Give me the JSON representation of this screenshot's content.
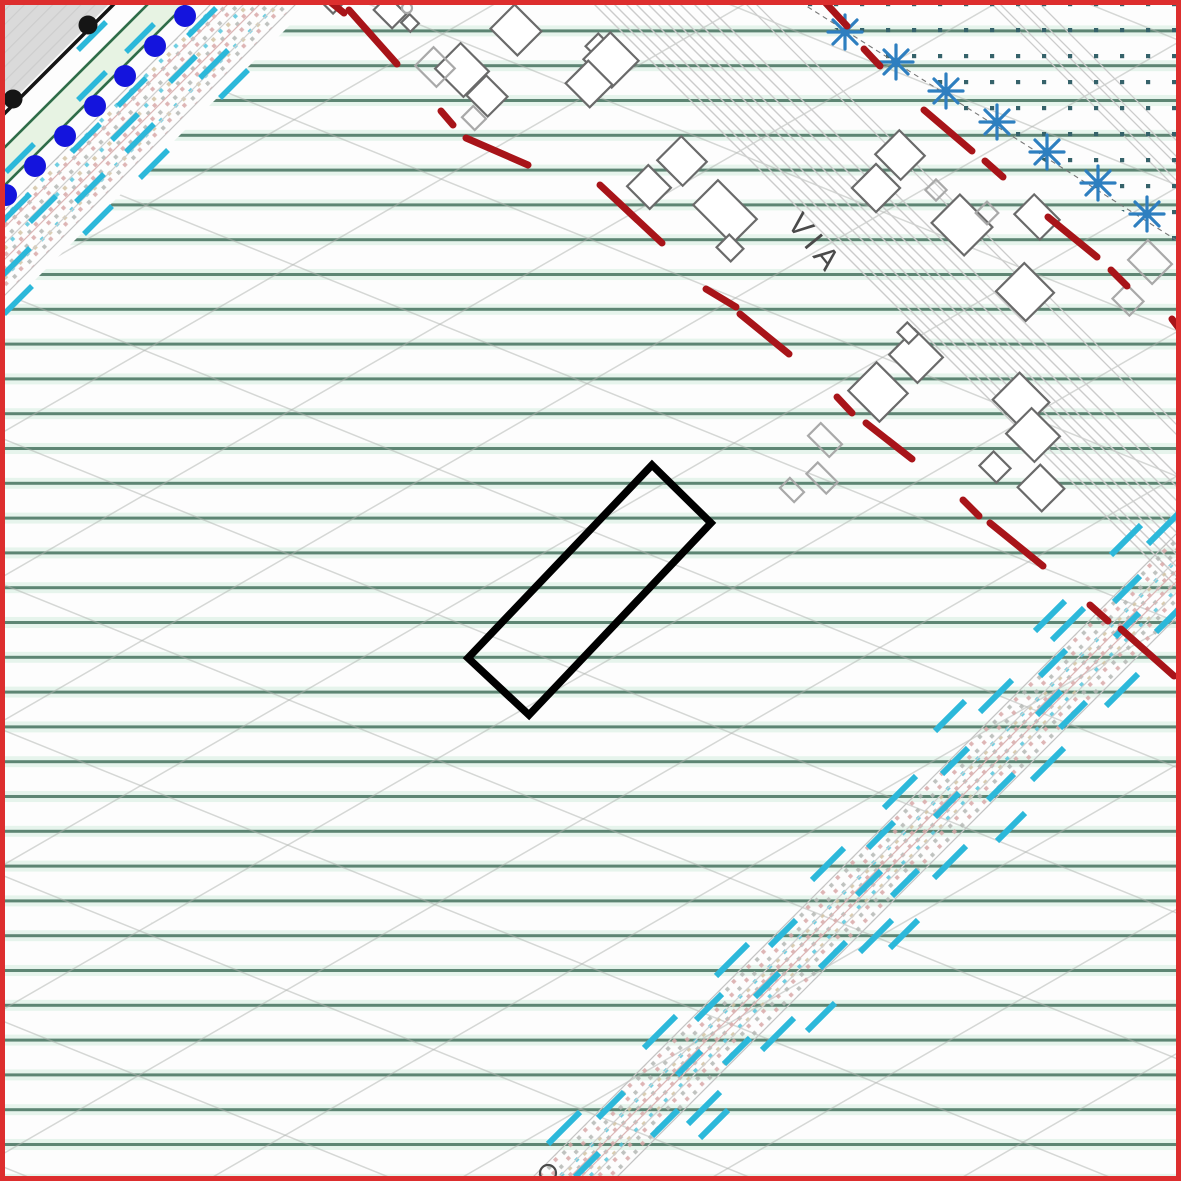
{
  "map": {
    "via_label": {
      "text": "VIA",
      "x": 786,
      "y": 224,
      "rotate": 51,
      "size": 31,
      "letter_spacing": 6
    },
    "palette": {
      "frame_red": "#dd2e2e",
      "hatch_green": "#5d8573",
      "hatch_green_halo": "#e6f4ec",
      "diag_gray": "#adb2ad",
      "road_gray": "#cbcbcb",
      "building_dark": "#6a6a6a",
      "building_light": "#a9a9a9",
      "red_dash": "#a81419",
      "cyan_dash": "#2cb8da",
      "corridor_edge": "#c4c4c4",
      "corridor_line_pink": "#dcb6b6",
      "corridor_line_gray": "#cfcfcf",
      "corridor_dot_pink": "#d8a8a8",
      "corridor_dot_gray": "#b4b8b4",
      "corridor_dot_cyan": "#56c6dc",
      "corridor_dot_tan": "#d2c3a4",
      "teal_dot": "#35626a",
      "asterisk_blue": "#2e7fc0",
      "asterisk_wire": "#777777",
      "blue_dot": "#1414dd",
      "black": "#151515",
      "green_band_line": "#2f6d49",
      "green_band_fill": "#e7f3e3",
      "gray_area": "#dadada",
      "via_text": "#4a4a4a",
      "parcel": "#000000",
      "background": "#fdfdfd"
    },
    "hatches": {
      "green": {
        "spacing": 34.8,
        "phase": 13.5,
        "line_w": 3.0,
        "halo_w": 4.0
      },
      "diag_up": {
        "angle": -30,
        "spacing": 125,
        "line_w": 1.5
      },
      "diag_down": {
        "angle": 22,
        "spacing": 135,
        "line_w": 1.5
      },
      "rural_clip": [
        [
          315,
          0
        ],
        [
          1181,
          0
        ],
        [
          1181,
          1181
        ],
        [
          0,
          1181
        ],
        [
          0,
          315
        ]
      ]
    },
    "gray_corner": {
      "points": [
        [
          0,
          0
        ],
        [
          113,
          0
        ],
        [
          0,
          113
        ]
      ]
    },
    "black_line": {
      "x1": 122,
      "y1": -4,
      "x2": -4,
      "y2": 122,
      "width": 3.5,
      "dot_r": 9.5,
      "dots": [
        [
          88,
          25
        ],
        [
          13,
          99
        ]
      ]
    },
    "green_band": {
      "offsets": [
        152,
        190
      ],
      "line_w": 2.6,
      "fill_quad": [
        [
          152,
          0
        ],
        [
          190,
          0
        ],
        [
          0,
          190
        ],
        [
          0,
          152
        ]
      ]
    },
    "blue_dots": {
      "r": 11,
      "centers": [
        [
          185,
          16
        ],
        [
          155,
          46
        ],
        [
          125,
          76
        ],
        [
          95,
          106
        ],
        [
          65,
          136
        ],
        [
          35,
          166
        ],
        [
          6,
          195
        ]
      ]
    },
    "teal_region": {
      "polygon": [
        [
          790,
          0
        ],
        [
          1181,
          0
        ],
        [
          1181,
          248
        ]
      ],
      "grid": 26,
      "dot": 4.2
    },
    "asterisk_line": {
      "x1": 800,
      "y1": 2,
      "x2": 1181,
      "y2": 243
    },
    "asterisks": {
      "size": 17,
      "arm_w": 3.2,
      "centers": [
        [
          845,
          32
        ],
        [
          896,
          62
        ],
        [
          946,
          91
        ],
        [
          997,
          122
        ],
        [
          1047,
          152
        ],
        [
          1098,
          183
        ],
        [
          1147,
          214
        ]
      ]
    },
    "roads": {
      "main": {
        "offsets": [
          590,
          600,
          610,
          622,
          632,
          644,
          654,
          664,
          676,
          690,
          702
        ],
        "width": 1.4
      },
      "west": {
        "offsets": [
          742,
          752
        ],
        "width": 1.3
      },
      "far": {
        "offsets": [
          988,
          996,
          1012,
          1020,
          1036
        ],
        "width": 1.3
      }
    },
    "corridors": [
      {
        "name": "tl",
        "band": [
          215,
          300
        ],
        "inner": [
          [
            232,
            "pink"
          ],
          [
            248,
            "gray"
          ],
          [
            264,
            "pink"
          ],
          [
            282,
            "gray"
          ]
        ],
        "dash_w": 5.5,
        "strips": [
          {
            "o": 128,
            "x0": 78,
            "n": 2,
            "step": 48,
            "len": 28
          },
          {
            "o": 178,
            "x0": 6,
            "n": 3,
            "step": 60,
            "len": 28
          },
          {
            "o": 224,
            "x0": 2,
            "n": 4,
            "step": 58,
            "len": 28
          },
          {
            "o": 252,
            "x0": 30,
            "n": 3,
            "step": 70,
            "len": 26
          },
          {
            "o": 278,
            "x0": 2,
            "n": 4,
            "step": 62,
            "len": 28
          },
          {
            "o": 318,
            "x0": 4,
            "n": 4,
            "step": 68,
            "len": 28
          }
        ]
      },
      {
        "name": "br",
        "band": [
          1710,
          1794
        ],
        "inner": [
          [
            1736,
            "gray"
          ],
          [
            1747,
            "pink"
          ],
          [
            1758,
            "pink"
          ],
          [
            1769,
            "gray"
          ]
        ],
        "dash_w": 6,
        "strips": [
          {
            "o": 1666,
            "x0": 935,
            "n": 3,
            "step": 88,
            "len": 30
          },
          {
            "o": 1692,
            "x0": 548,
            "n": 8,
            "step": 84,
            "len": 32
          },
          {
            "o": 1716,
            "x0": 598,
            "n": 7,
            "step": 86,
            "len": 26
          },
          {
            "o": 1752,
            "x0": 575,
            "n": 7,
            "step": 90,
            "len": 24
          },
          {
            "o": 1788,
            "x0": 556,
            "n": 8,
            "step": 84,
            "len": 26
          },
          {
            "o": 1812,
            "x0": 590,
            "n": 7,
            "step": 86,
            "len": 32
          },
          {
            "o": 1838,
            "x0": 700,
            "n": 4,
            "step": 95,
            "len": 28
          }
        ]
      }
    ],
    "red_dashes": {
      "width": 7,
      "segments": [
        [
          328,
          0,
          344,
          13
        ],
        [
          349,
          10,
          397,
          64
        ],
        [
          441,
          111,
          453,
          125
        ],
        [
          466,
          138,
          528,
          165
        ],
        [
          600,
          185,
          662,
          243
        ],
        [
          706,
          289,
          736,
          307
        ],
        [
          740,
          314,
          789,
          354
        ],
        [
          837,
          397,
          852,
          413
        ],
        [
          866,
          423,
          912,
          459
        ],
        [
          963,
          500,
          979,
          516
        ],
        [
          990,
          523,
          1043,
          566
        ],
        [
          1090,
          605,
          1108,
          621
        ],
        [
          1121,
          629,
          1174,
          676
        ],
        [
          823,
          0,
          847,
          26
        ],
        [
          864,
          49,
          880,
          66
        ],
        [
          924,
          110,
          972,
          151
        ],
        [
          985,
          161,
          1003,
          177
        ],
        [
          1048,
          217,
          1097,
          257
        ],
        [
          1111,
          270,
          1127,
          286
        ],
        [
          1172,
          319,
          1181,
          331
        ]
      ]
    },
    "buildings": {
      "stroke_w": 2.2,
      "rotation": 45,
      "items": [
        {
          "x": 390,
          "y": 12,
          "w": 26,
          "h": 20,
          "shade": "dark"
        },
        {
          "x": 410,
          "y": 23,
          "w": 13,
          "h": 12,
          "shade": "dark"
        },
        {
          "x": 332,
          "y": 4,
          "w": 15,
          "h": 12,
          "shade": "dark"
        },
        {
          "x": 462,
          "y": 70,
          "w": 40,
          "h": 36,
          "shade": "dark"
        },
        {
          "x": 487,
          "y": 96,
          "w": 30,
          "h": 28,
          "shade": "dark"
        },
        {
          "x": 516,
          "y": 30,
          "w": 38,
          "h": 34,
          "shade": "dark"
        },
        {
          "x": 599,
          "y": 47,
          "w": 20,
          "h": 18,
          "shade": "dark"
        },
        {
          "x": 611,
          "y": 60,
          "w": 40,
          "h": 38,
          "shade": "dark"
        },
        {
          "x": 589,
          "y": 84,
          "w": 34,
          "h": 32,
          "shade": "dark"
        },
        {
          "x": 682,
          "y": 161,
          "w": 36,
          "h": 34,
          "shade": "dark"
        },
        {
          "x": 649,
          "y": 187,
          "w": 32,
          "h": 30,
          "shade": "dark"
        },
        {
          "x": 725,
          "y": 212,
          "w": 55,
          "h": 35,
          "shade": "dark"
        },
        {
          "x": 730,
          "y": 248,
          "w": 20,
          "h": 18,
          "shade": "dark"
        },
        {
          "x": 900,
          "y": 155,
          "w": 36,
          "h": 34,
          "shade": "dark"
        },
        {
          "x": 876,
          "y": 188,
          "w": 34,
          "h": 34,
          "shade": "dark"
        },
        {
          "x": 962,
          "y": 225,
          "w": 46,
          "h": 40,
          "shade": "dark"
        },
        {
          "x": 1037,
          "y": 217,
          "w": 36,
          "h": 28,
          "shade": "dark"
        },
        {
          "x": 1025,
          "y": 292,
          "w": 42,
          "h": 40,
          "shade": "dark"
        },
        {
          "x": 878,
          "y": 392,
          "w": 44,
          "h": 40,
          "shade": "dark"
        },
        {
          "x": 916,
          "y": 356,
          "w": 40,
          "h": 36,
          "shade": "dark"
        },
        {
          "x": 908,
          "y": 333,
          "w": 16,
          "h": 14,
          "shade": "dark"
        },
        {
          "x": 1021,
          "y": 401,
          "w": 42,
          "h": 38,
          "shade": "dark"
        },
        {
          "x": 1033,
          "y": 435,
          "w": 40,
          "h": 36,
          "shade": "dark"
        },
        {
          "x": 995,
          "y": 467,
          "w": 24,
          "h": 20,
          "shade": "dark"
        },
        {
          "x": 1041,
          "y": 488,
          "w": 34,
          "h": 32,
          "shade": "dark"
        },
        {
          "x": 435,
          "y": 67,
          "w": 30,
          "h": 26,
          "shade": "light"
        },
        {
          "x": 474,
          "y": 118,
          "w": 18,
          "h": 16,
          "shade": "light"
        },
        {
          "x": 936,
          "y": 190,
          "w": 15,
          "h": 15,
          "shade": "light"
        },
        {
          "x": 987,
          "y": 213,
          "w": 16,
          "h": 16,
          "shade": "light"
        },
        {
          "x": 825,
          "y": 440,
          "w": 30,
          "h": 18,
          "shade": "light"
        },
        {
          "x": 822,
          "y": 478,
          "w": 28,
          "h": 16,
          "shade": "light"
        },
        {
          "x": 792,
          "y": 490,
          "w": 20,
          "h": 14,
          "shade": "light"
        },
        {
          "x": 1150,
          "y": 262,
          "w": 34,
          "h": 28,
          "shade": "light"
        },
        {
          "x": 1128,
          "y": 300,
          "w": 24,
          "h": 20,
          "shade": "light"
        }
      ],
      "circles": [
        {
          "x": 548,
          "y": 1173,
          "r": 8,
          "shade": "dark"
        },
        {
          "x": 407,
          "y": 8,
          "r": 5,
          "shade": "light"
        }
      ]
    },
    "parcel": {
      "points": [
        [
          652,
          465
        ],
        [
          711,
          523
        ],
        [
          529,
          715
        ],
        [
          468,
          658
        ]
      ],
      "stroke_w": 7.5
    },
    "frame": {
      "inset": 2.5,
      "stroke_w": 5
    }
  }
}
